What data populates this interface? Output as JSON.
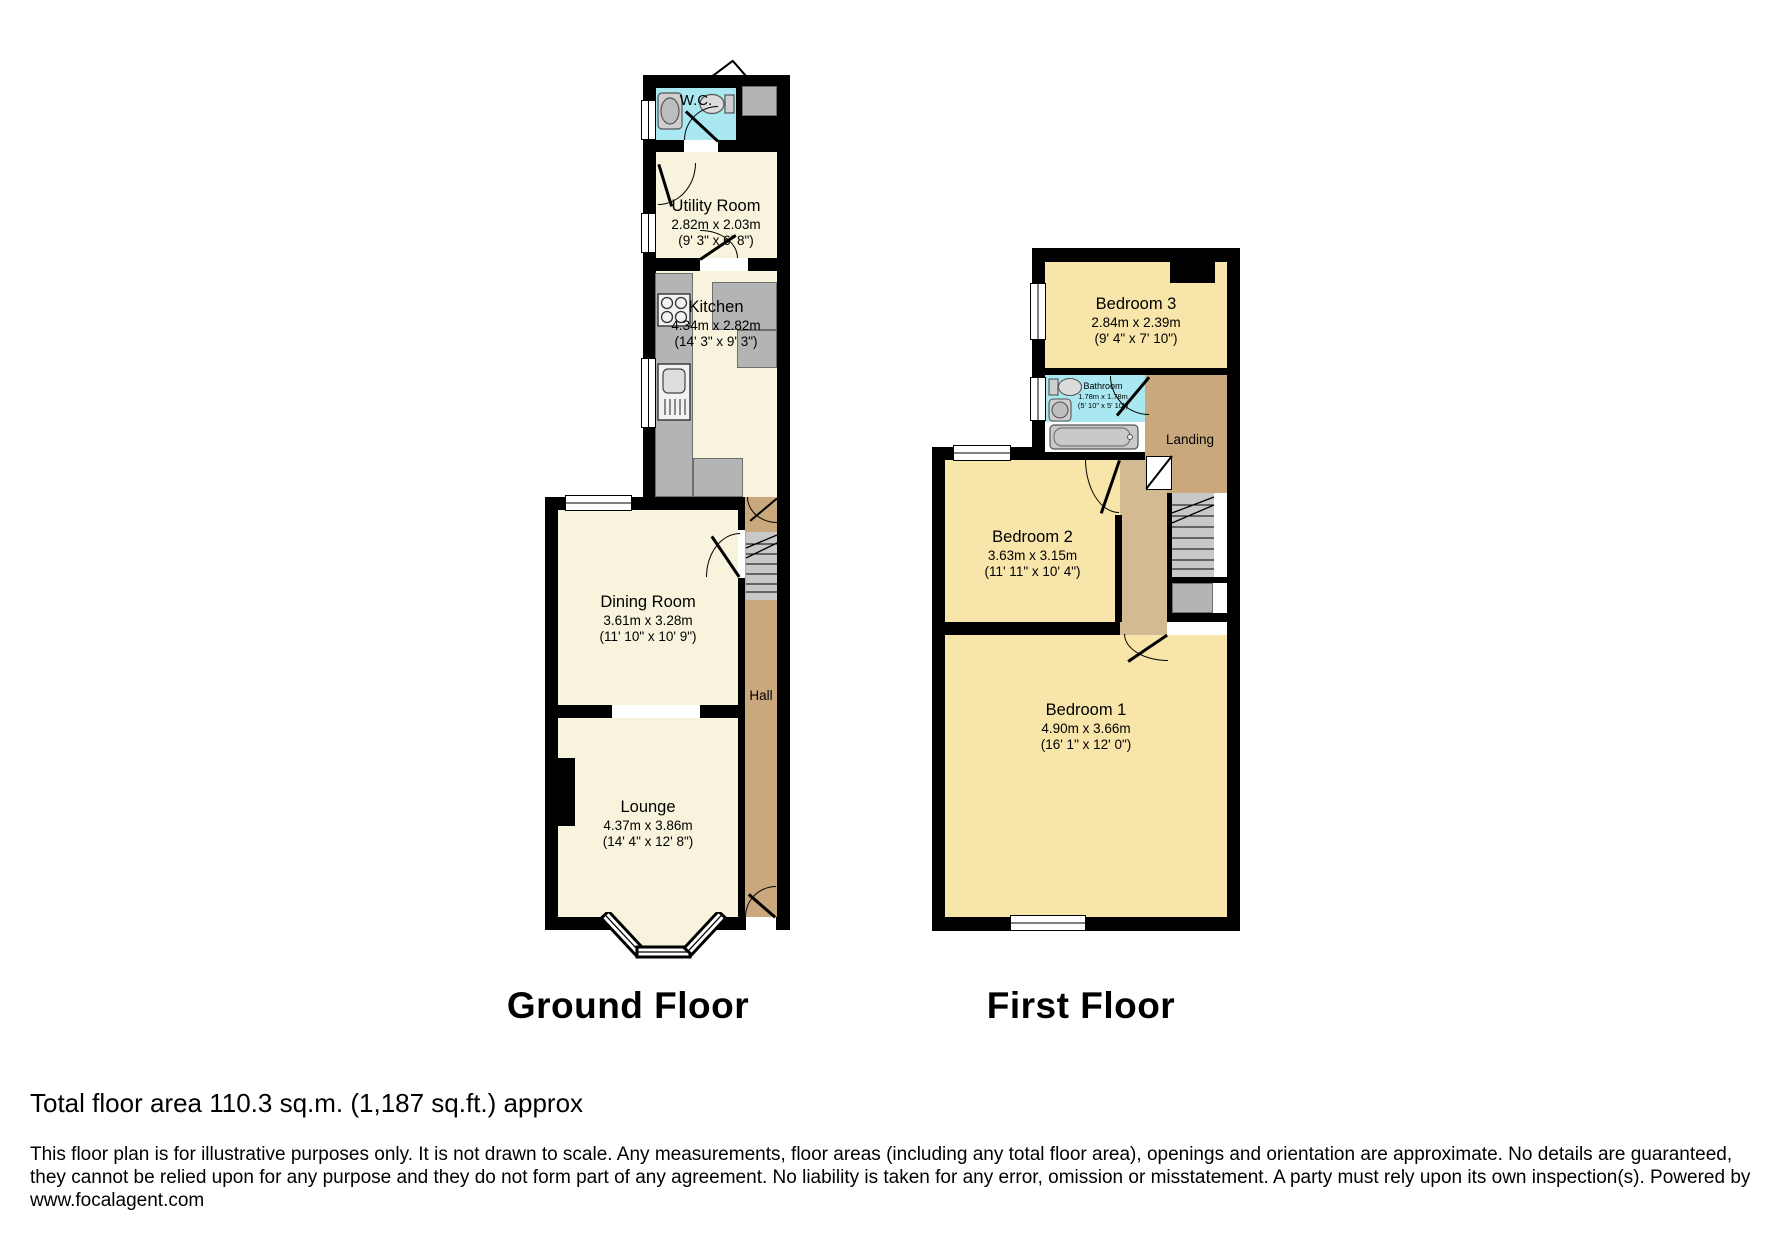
{
  "ground_floor": {
    "label": "Ground Floor",
    "rooms": {
      "wc": {
        "name": "W.C."
      },
      "utility": {
        "name": "Utility Room",
        "dims_m": "2.82m x 2.03m",
        "dims_ft": "(9' 3\" x 6' 8\")"
      },
      "kitchen": {
        "name": "Kitchen",
        "dims_m": "4.34m x 2.82m",
        "dims_ft": "(14' 3\" x 9' 3\")"
      },
      "dining": {
        "name": "Dining Room",
        "dims_m": "3.61m x 3.28m",
        "dims_ft": "(11' 10\" x 10' 9\")"
      },
      "hall": {
        "name": "Hall"
      },
      "lounge": {
        "name": "Lounge",
        "dims_m": "4.37m x 3.86m",
        "dims_ft": "(14' 4\" x 12' 8\")"
      }
    }
  },
  "first_floor": {
    "label": "First Floor",
    "rooms": {
      "bedroom3": {
        "name": "Bedroom 3",
        "dims_m": "2.84m x 2.39m",
        "dims_ft": "(9' 4\" x 7' 10\")"
      },
      "bathroom": {
        "name": "Bathroom",
        "dims_m": "1.78m x 1.78m",
        "dims_ft": "(5' 10\" x 5' 10\")"
      },
      "landing": {
        "name": "Landing"
      },
      "bedroom2": {
        "name": "Bedroom 2",
        "dims_m": "3.63m x 3.15m",
        "dims_ft": "(11' 11\" x 10' 4\")"
      },
      "bedroom1": {
        "name": "Bedroom 1",
        "dims_m": "4.90m x 3.66m",
        "dims_ft": "(16' 1\" x 12' 0\")"
      }
    }
  },
  "footer": {
    "total_area": "Total floor area 110.3 sq.m. (1,187 sq.ft.) approx",
    "disclaimer_line1": "This floor plan is for illustrative purposes only. It is not drawn to scale. Any measurements, floor areas (including any total floor area), openings and orientation are approximate. No details are guaranteed,",
    "disclaimer_line2": "they cannot be relied upon for any purpose and they do not form part of any agreement. No liability is taken for any error, omission or misstatement. A party must rely upon its own inspection(s). Powered by",
    "website": "www.focalagent.com"
  },
  "colors": {
    "room_cream": "#f8f3dc",
    "bedroom_yellow": "#f8e5a9",
    "wet_room_cyan": "#a9e8f0",
    "hall_tan": "#c9a87e",
    "corridor_tan": "#d4ba92",
    "fixture_gray": "#b4b4b4",
    "wall_black": "#000000"
  }
}
